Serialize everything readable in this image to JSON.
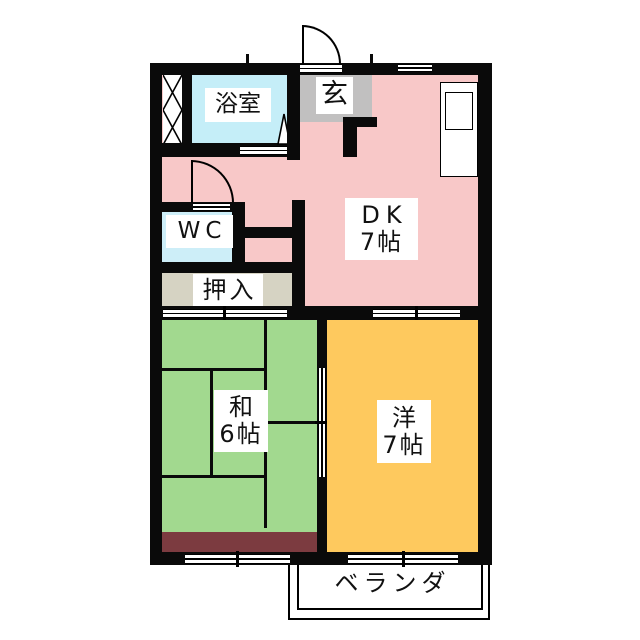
{
  "floorplan": {
    "rooms": {
      "bathroom": {
        "label": "浴室"
      },
      "entrance": {
        "label": "玄"
      },
      "toilet": {
        "label": "WC"
      },
      "closet": {
        "label": "押入"
      },
      "dining_kitchen": {
        "name": "DK",
        "size": "7帖"
      },
      "japanese_room": {
        "name": "和",
        "size": "6帖"
      },
      "western_room": {
        "name": "洋",
        "size": "7帖"
      },
      "veranda": {
        "label": "ベランダ"
      }
    },
    "features": {
      "entrance_door": "outward-swing door arc",
      "wc_door": "swing door arc",
      "kitchen_counter": "sink unit on right wall of DK",
      "sliding_doors": "fusuma between closet/japanese room, DK/western room, japanese/western room",
      "windows": "top wall window, two bottom wall windows",
      "pipe_space_hatch": "X-hatched shaft at top-left"
    },
    "colors": {
      "wall": "#0a0a0a",
      "dk_floor": "#f8c8c8",
      "bathroom_floor": "#c5eef8",
      "toilet_floor": "#cdeef8",
      "entrance_floor": "#c1c0c0",
      "closet_floor": "#d6d3c3",
      "japanese_room_floor": "#a2d98f",
      "tatami_edge_strip": "#7c3b40",
      "western_room_floor": "#fec95e"
    }
  }
}
